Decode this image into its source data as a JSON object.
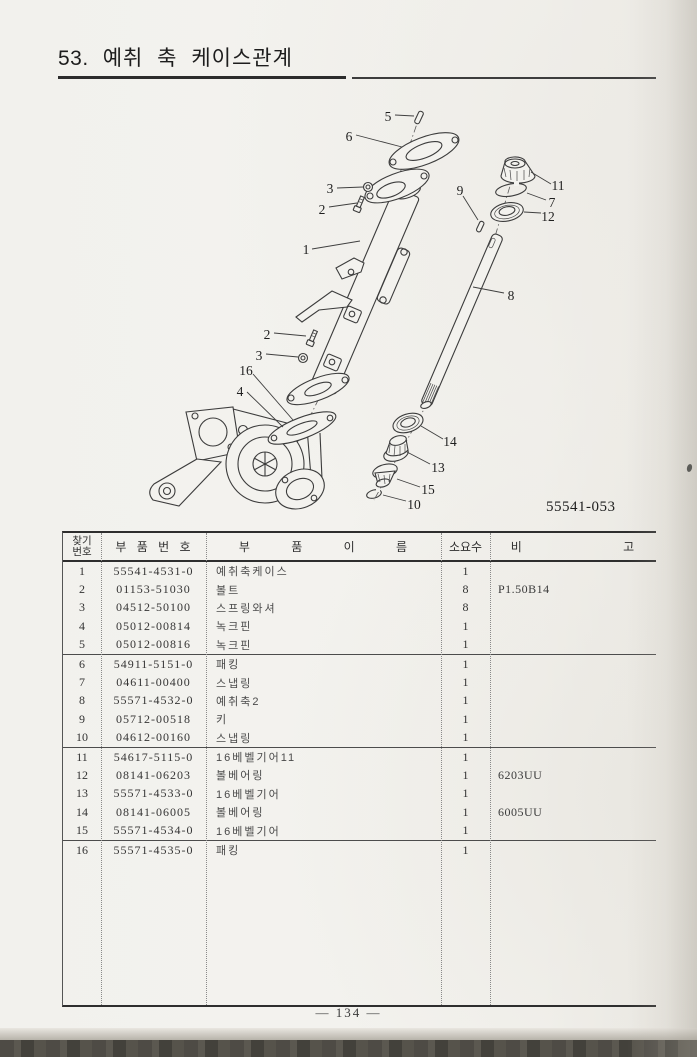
{
  "page": {
    "section_no": "53.",
    "title": "예취 축 케이스관계",
    "diagram_id": "55541-053",
    "footer": "— 134 —"
  },
  "diagram": {
    "callout_labels": [
      "1",
      "2",
      "3",
      "4",
      "5",
      "6",
      "7",
      "8",
      "9",
      "10",
      "11",
      "12",
      "13",
      "14",
      "15",
      "16"
    ]
  },
  "table": {
    "headers": {
      "find_no_line1": "찾기",
      "find_no_line2": "번호",
      "part_no": "부 품 번 호",
      "part_name": "부 품 이 름",
      "qty": "소요수",
      "remarks": "비 고"
    },
    "rows": [
      {
        "no": "1",
        "part_no": "55541-4531-0",
        "name": "예취축케이스",
        "qty": "1",
        "remark": ""
      },
      {
        "no": "2",
        "part_no": "01153-51030",
        "name": "볼트",
        "qty": "8",
        "remark": "P1.50B14"
      },
      {
        "no": "3",
        "part_no": "04512-50100",
        "name": "스프링와셔",
        "qty": "8",
        "remark": ""
      },
      {
        "no": "4",
        "part_no": "05012-00814",
        "name": "녹크핀",
        "qty": "1",
        "remark": ""
      },
      {
        "no": "5",
        "part_no": "05012-00816",
        "name": "녹크핀",
        "qty": "1",
        "remark": ""
      },
      {
        "no": "6",
        "part_no": "54911-5151-0",
        "name": "패킹",
        "qty": "1",
        "remark": ""
      },
      {
        "no": "7",
        "part_no": "04611-00400",
        "name": "스냅링",
        "qty": "1",
        "remark": ""
      },
      {
        "no": "8",
        "part_no": "55571-4532-0",
        "name": "예취축2",
        "qty": "1",
        "remark": ""
      },
      {
        "no": "9",
        "part_no": "05712-00518",
        "name": "키",
        "qty": "1",
        "remark": ""
      },
      {
        "no": "10",
        "part_no": "04612-00160",
        "name": "스냅링",
        "qty": "1",
        "remark": ""
      },
      {
        "no": "11",
        "part_no": "54617-5115-0",
        "name": "16베벨기어11",
        "qty": "1",
        "remark": ""
      },
      {
        "no": "12",
        "part_no": "08141-06203",
        "name": "볼베어링",
        "qty": "1",
        "remark": "6203UU"
      },
      {
        "no": "13",
        "part_no": "55571-4533-0",
        "name": "16베벨기어",
        "qty": "1",
        "remark": ""
      },
      {
        "no": "14",
        "part_no": "08141-06005",
        "name": "볼베어링",
        "qty": "1",
        "remark": "6005UU"
      },
      {
        "no": "15",
        "part_no": "55571-4534-0",
        "name": "16베벨기어",
        "qty": "1",
        "remark": ""
      },
      {
        "no": "16",
        "part_no": "55571-4535-0",
        "name": "패킹",
        "qty": "1",
        "remark": ""
      }
    ]
  }
}
